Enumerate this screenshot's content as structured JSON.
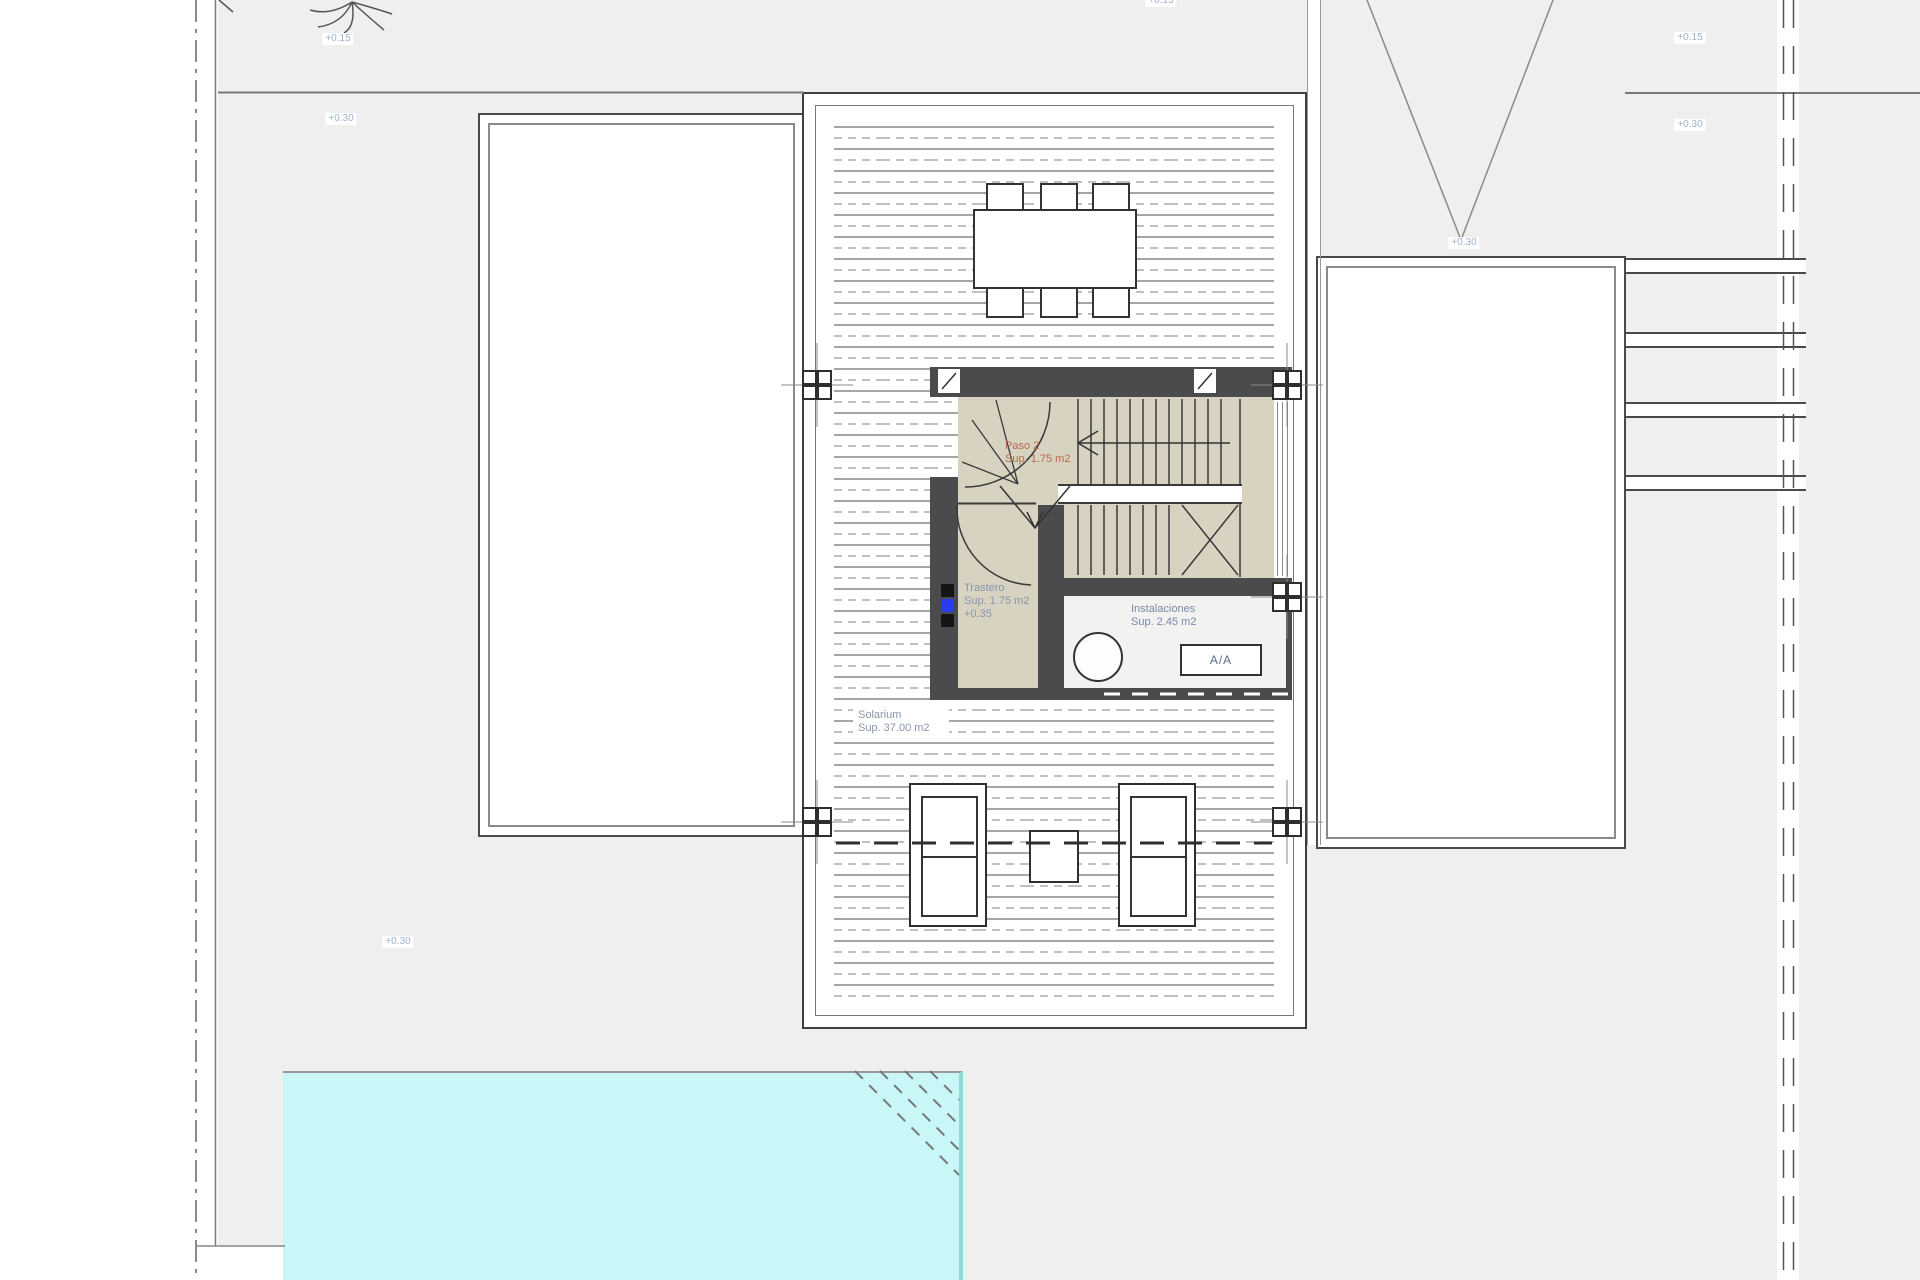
{
  "labels": {
    "elev_015_top_left": "+0.15",
    "elev_030_top_left": "+0.30",
    "elev_015_top_center": "+0.15",
    "elev_015_top_right": "+0.15",
    "elev_030_top_right": "+0.30",
    "elev_030_ramp": "+0.30",
    "elev_030_garden": "+0.30"
  },
  "rooms": {
    "paso2": {
      "name": "Paso 2",
      "area": "Sup. 1.75 m2"
    },
    "trastero": {
      "name": "Trastero",
      "area": "Sup. 1.75 m2",
      "level": "+0.35"
    },
    "instalaciones": {
      "name": "Instalaciones",
      "area": "Sup. 2.45 m2",
      "ac_unit": "A/A"
    },
    "solarium": {
      "name": "Solarium",
      "area": "Sup. 37.00 m2"
    }
  },
  "colors": {
    "site_bg": "#efeff0",
    "core_wall": "#4b4b4d",
    "pillar_dark": "#2e2e30",
    "stair_floor": "#d8d2c1",
    "pool_fill": "#c9f6f6",
    "room_label": "#8796ab",
    "elevation_label": "#9cb2d0",
    "paso_label": "#b96a50",
    "ac_label": "#5a6a88",
    "electrical_blue": "#2a3cf0"
  }
}
